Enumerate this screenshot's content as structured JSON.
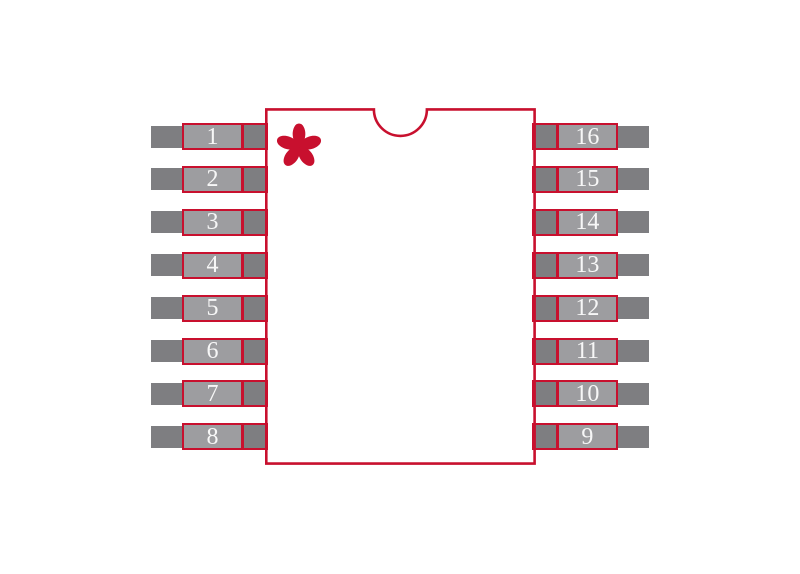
{
  "colors": {
    "outline": "#C8102E",
    "pad_fill": "#9D9DA0",
    "lead_fill": "#7E7E81",
    "digit": "#F7F7F7",
    "background": "#FFFFFF"
  },
  "pins": {
    "left": [
      "1",
      "2",
      "3",
      "4",
      "5",
      "6",
      "7",
      "8"
    ],
    "right": [
      "16",
      "15",
      "14",
      "13",
      "12",
      "11",
      "10",
      "9"
    ]
  },
  "markers": {
    "pin1_indicator": "asterisk-icon",
    "orientation_notch": "semicircle-notch"
  }
}
